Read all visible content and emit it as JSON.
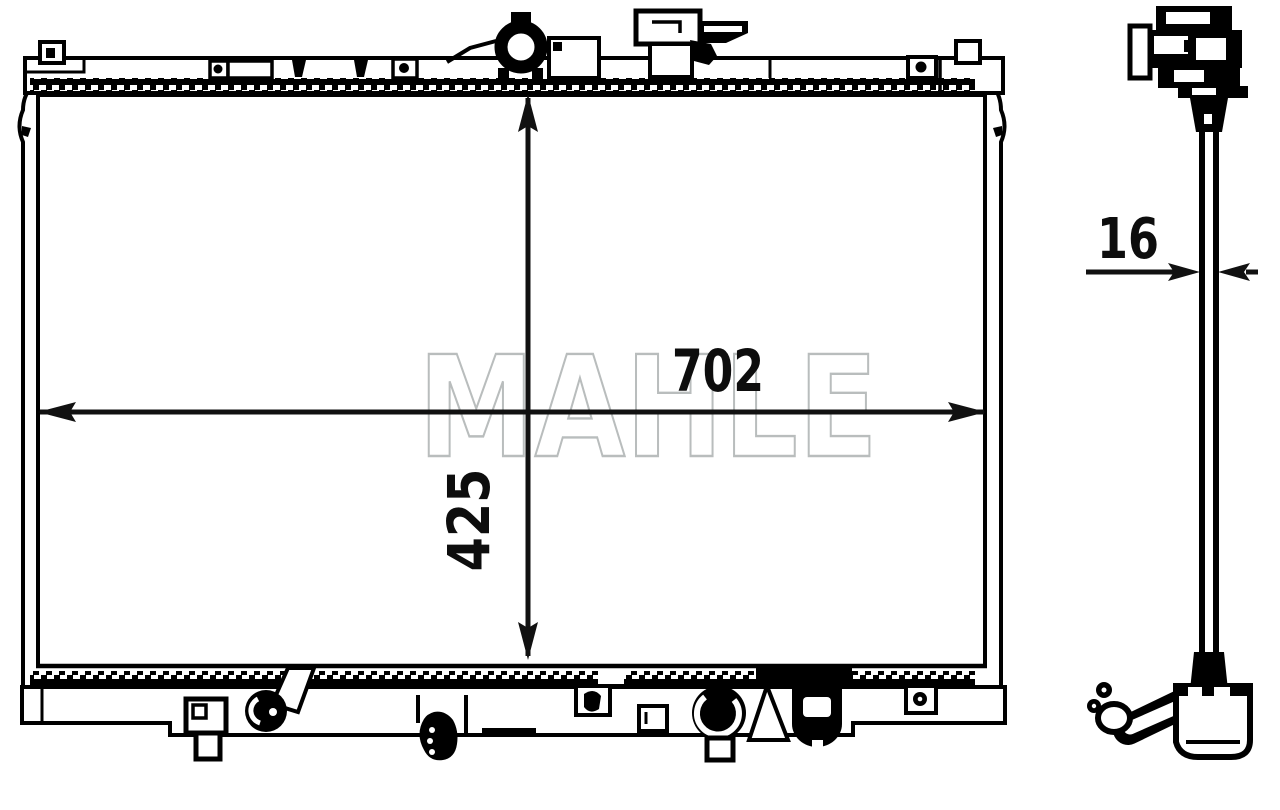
{
  "document": {
    "type": "radiator-technical-drawing",
    "views": [
      "front-view",
      "side-view"
    ]
  },
  "watermark": {
    "text": "MAHLE",
    "color": "#b9bdbd"
  },
  "drawing": {
    "front_view": {
      "width_label": "702",
      "height_label": "425"
    },
    "side_view": {
      "depth_label": "16"
    }
  },
  "colors": {
    "line": "#000000",
    "dimension": "#111111",
    "background": "#ffffff"
  }
}
